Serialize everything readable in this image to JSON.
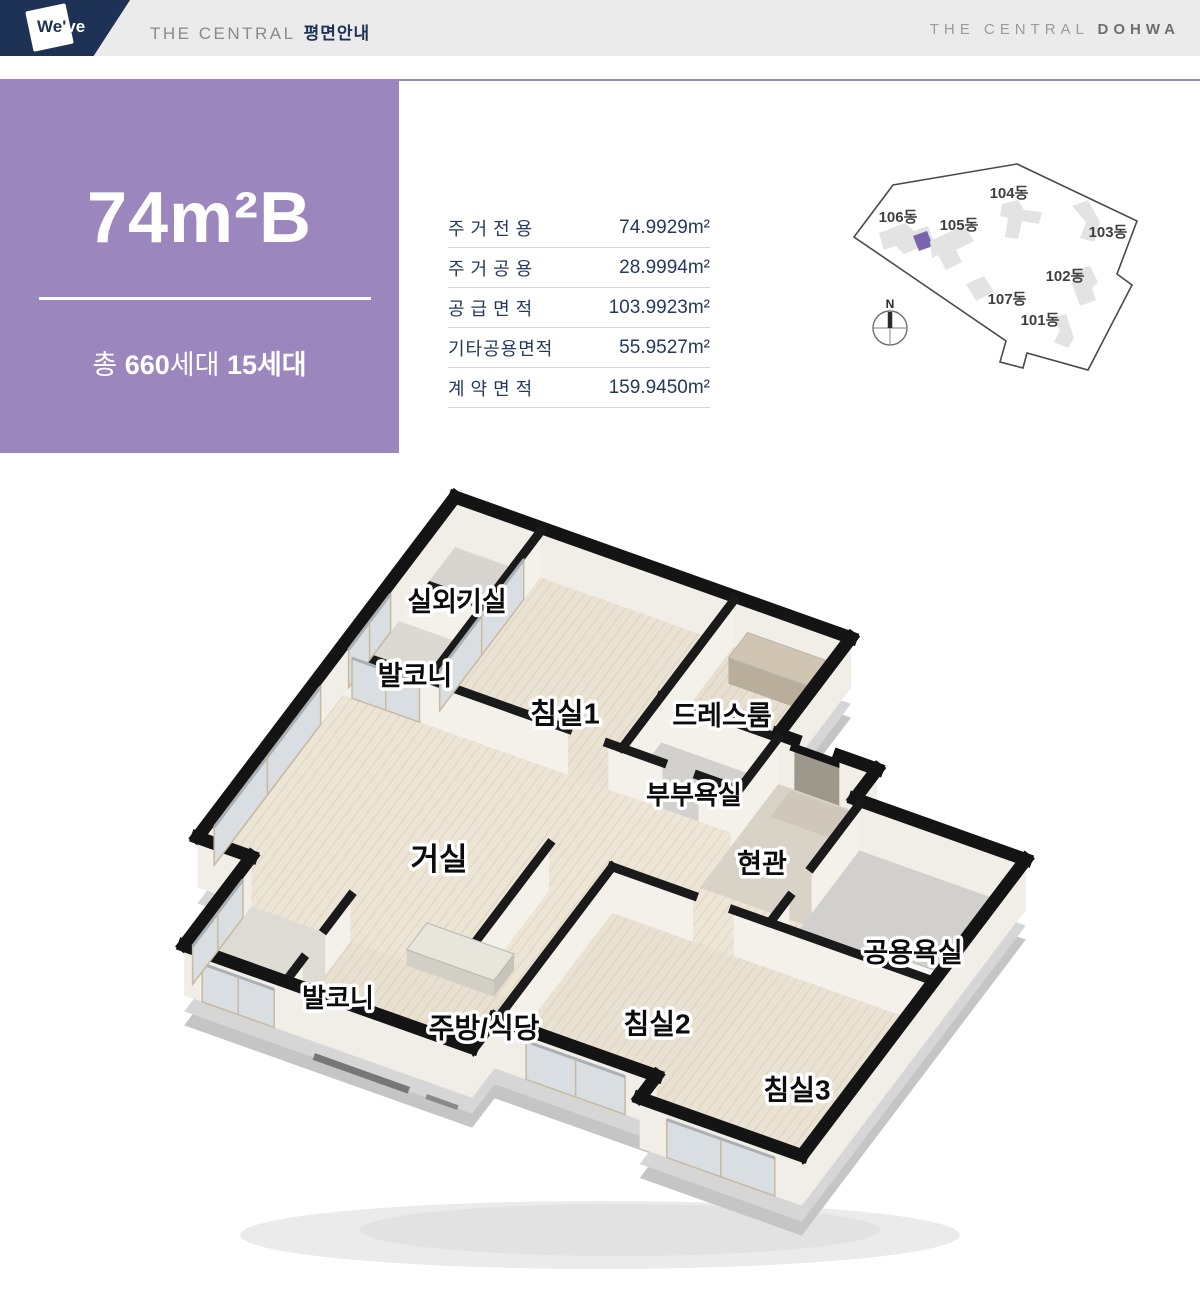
{
  "header": {
    "logo_we": "We'",
    "logo_ve": "ve",
    "title_main": "THE CENTRAL",
    "title_sub": "평면안내",
    "brand_main": "THE CENTRAL",
    "brand_strong": "DOHWA"
  },
  "unit_card": {
    "type_name": "74m²B",
    "total_prefix": "총 ",
    "total_count": "660",
    "total_suffix": "세대 ",
    "unit_count": "15세대",
    "bg_color": "#9b86bd"
  },
  "area_table": {
    "rows": [
      {
        "label": "주거전용",
        "value": "74.9929m²",
        "spaced": true
      },
      {
        "label": "주거공용",
        "value": "28.9994m²",
        "spaced": true
      },
      {
        "label": "공급면적",
        "value": "103.9923m²",
        "spaced": true
      },
      {
        "label": "기타공용면적",
        "value": "55.9527m²",
        "spaced": false
      },
      {
        "label": "계약면적",
        "value": "159.9450m²",
        "spaced": true
      }
    ]
  },
  "site_map": {
    "compass_label": "N",
    "highlight_color": "#7c63ad",
    "buildings": [
      {
        "label": "104동"
      },
      {
        "label": "106동"
      },
      {
        "label": "105동"
      },
      {
        "label": "103동"
      },
      {
        "label": "102동"
      },
      {
        "label": "107동"
      },
      {
        "label": "101동"
      }
    ]
  },
  "floor_plan": {
    "rooms": [
      {
        "label": "실외기실",
        "x": 457,
        "y": 604,
        "size": 27
      },
      {
        "label": "발코니",
        "x": 415,
        "y": 678,
        "size": 27
      },
      {
        "label": "침실1",
        "x": 565,
        "y": 716,
        "size": 29
      },
      {
        "label": "드레스룸",
        "x": 722,
        "y": 718,
        "size": 27
      },
      {
        "label": "부부욕실",
        "x": 694,
        "y": 797,
        "size": 26
      },
      {
        "label": "거실",
        "x": 439,
        "y": 862,
        "size": 31
      },
      {
        "label": "현관",
        "x": 762,
        "y": 866,
        "size": 27
      },
      {
        "label": "공용욕실",
        "x": 913,
        "y": 955,
        "size": 27
      },
      {
        "label": "발코니",
        "x": 338,
        "y": 1000,
        "size": 26
      },
      {
        "label": "주방/식당",
        "x": 484,
        "y": 1030,
        "size": 28
      },
      {
        "label": "침실2",
        "x": 657,
        "y": 1026,
        "size": 28
      },
      {
        "label": "침실3",
        "x": 797,
        "y": 1092,
        "size": 28
      }
    ]
  }
}
